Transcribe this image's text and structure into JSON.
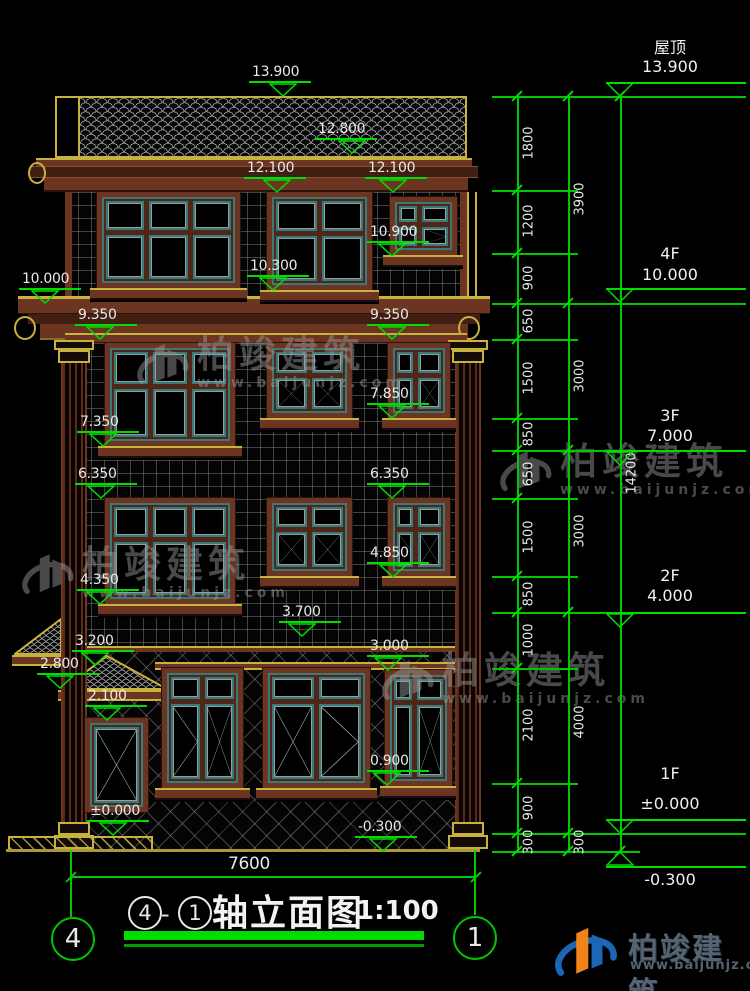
{
  "title": {
    "axis_from": "4",
    "dash": "-",
    "axis_to": "1",
    "name": "轴立面图",
    "scale": "1:100"
  },
  "axes": {
    "left": "4",
    "right": "1"
  },
  "dims": {
    "total_width": "7600",
    "ext_lines": [
      {
        "y": 96,
        "x1": 492,
        "x2": 746
      },
      {
        "y": 303,
        "x1": 492,
        "x2": 746
      },
      {
        "y": 450,
        "x1": 492,
        "x2": 746
      },
      {
        "y": 612,
        "x1": 492,
        "x2": 746
      },
      {
        "y": 833,
        "x1": 492,
        "x2": 746
      },
      {
        "y": 851,
        "x1": 492,
        "x2": 640
      },
      {
        "y": 190,
        "x1": 492,
        "x2": 578
      },
      {
        "y": 253,
        "x1": 492,
        "x2": 578
      },
      {
        "y": 339,
        "x1": 492,
        "x2": 578
      },
      {
        "y": 418,
        "x1": 492,
        "x2": 578
      },
      {
        "y": 498,
        "x1": 492,
        "x2": 578
      },
      {
        "y": 576,
        "x1": 492,
        "x2": 578
      },
      {
        "y": 668,
        "x1": 492,
        "x2": 578
      },
      {
        "y": 783,
        "x1": 492,
        "x2": 578
      }
    ],
    "chains": [
      {
        "x": 517,
        "y1": 96,
        "y2": 851,
        "ticks": [
          96,
          190,
          253,
          303,
          339,
          418,
          450,
          498,
          576,
          612,
          668,
          783,
          833,
          851
        ],
        "labels": [
          {
            "text": "1800",
            "y": 143
          },
          {
            "text": "1200",
            "y": 221
          },
          {
            "text": "900",
            "y": 278
          },
          {
            "text": "650",
            "y": 321
          },
          {
            "text": "1500",
            "y": 378
          },
          {
            "text": "850",
            "y": 434
          },
          {
            "text": "650",
            "y": 474
          },
          {
            "text": "1500",
            "y": 537
          },
          {
            "text": "850",
            "y": 594
          },
          {
            "text": "1000",
            "y": 640
          },
          {
            "text": "2100",
            "y": 725
          },
          {
            "text": "900",
            "y": 808
          },
          {
            "text": "300",
            "y": 842
          }
        ]
      },
      {
        "x": 568,
        "y1": 96,
        "y2": 851,
        "ticks": [
          96,
          303,
          450,
          612,
          833,
          851
        ],
        "labels": [
          {
            "text": "3900",
            "y": 199
          },
          {
            "text": "3000",
            "y": 376
          },
          {
            "text": "3000",
            "y": 531
          },
          {
            "text": "4000",
            "y": 722
          },
          {
            "text": "300",
            "y": 842
          }
        ]
      },
      {
        "x": 620,
        "y1": 96,
        "y2": 851,
        "ticks": [
          96,
          851
        ],
        "labels": [
          {
            "text": "14200",
            "y": 473
          }
        ]
      }
    ]
  },
  "floor_markers": [
    {
      "label": "屋顶",
      "value": "13.900",
      "line_y": 96,
      "bar_y": 82,
      "tri_y": 82,
      "label_y": 34,
      "value_y": 57,
      "flip": false
    },
    {
      "label": "4F",
      "value": "10.000",
      "line_y": 303,
      "bar_y": 288,
      "tri_y": 288,
      "label_y": 244,
      "value_y": 265,
      "flip": false
    },
    {
      "label": "3F",
      "value": "7.000",
      "line_y": 450,
      "bar_y": 450,
      "tri_y": 451,
      "label_y": 406,
      "value_y": 426,
      "flip": false
    },
    {
      "label": "2F",
      "value": "4.000",
      "line_y": 612,
      "bar_y": 612,
      "tri_y": 613,
      "label_y": 566,
      "value_y": 586,
      "flip": false
    },
    {
      "label": "1F",
      "value": "±0.000",
      "line_y": 833,
      "bar_y": 819,
      "tri_y": 819,
      "label_y": 764,
      "value_y": 794,
      "flip": false
    },
    {
      "label": "",
      "value": "-0.300",
      "line_y": 851,
      "bar_y": 866,
      "tri_y": 851,
      "label_y": 0,
      "value_y": 870,
      "flip": true
    }
  ],
  "elev_markers": [
    {
      "value": "13.900",
      "tx": 252,
      "tipx": 283,
      "tipy": 96
    },
    {
      "value": "12.800",
      "tx": 318,
      "tipx": 352,
      "tipy": 153
    },
    {
      "value": "12.100",
      "tx": 247,
      "tipx": 277,
      "tipy": 192
    },
    {
      "value": "12.100",
      "tx": 368,
      "tipx": 393,
      "tipy": 192
    },
    {
      "value": "10.900",
      "tx": 370,
      "tipx": 392,
      "tipy": 256
    },
    {
      "value": "10.300",
      "tx": 250,
      "tipx": 273,
      "tipy": 290
    },
    {
      "value": "10.000",
      "tx": 22,
      "tipx": 45,
      "tipy": 303
    },
    {
      "value": "9.350",
      "tx": 78,
      "tipx": 100,
      "tipy": 339
    },
    {
      "value": "9.350",
      "tx": 370,
      "tipx": 392,
      "tipy": 339
    },
    {
      "value": "7.850",
      "tx": 370,
      "tipx": 392,
      "tipy": 418
    },
    {
      "value": "7.350",
      "tx": 80,
      "tipx": 103,
      "tipy": 446
    },
    {
      "value": "6.350",
      "tx": 78,
      "tipx": 101,
      "tipy": 498
    },
    {
      "value": "6.350",
      "tx": 370,
      "tipx": 392,
      "tipy": 498
    },
    {
      "value": "4.850",
      "tx": 370,
      "tipx": 393,
      "tipy": 577
    },
    {
      "value": "4.350",
      "tx": 80,
      "tipx": 100,
      "tipy": 604
    },
    {
      "value": "3.700",
      "tx": 282,
      "tipx": 302,
      "tipy": 636
    },
    {
      "value": "3.200",
      "tx": 75,
      "tipx": 95,
      "tipy": 665
    },
    {
      "value": "3.000",
      "tx": 370,
      "tipx": 388,
      "tipy": 670
    },
    {
      "value": "2.800",
      "tx": 40,
      "tipx": 60,
      "tipy": 688
    },
    {
      "value": "2.100",
      "tx": 88,
      "tipx": 107,
      "tipy": 720
    },
    {
      "value": "0.900",
      "tx": 370,
      "tipx": 387,
      "tipy": 785
    },
    {
      "value": "±0.000",
      "tx": 90,
      "tipx": 113,
      "tipy": 835
    },
    {
      "value": "-0.300",
      "tx": 358,
      "tipx": 383,
      "tipy": 851
    }
  ],
  "building": {
    "windows": [
      {
        "id": "win-4f-left",
        "x": 97,
        "y": 192,
        "w": 143,
        "h": 96,
        "cols": [
          1,
          1,
          1
        ],
        "rows": [
          4,
          6
        ],
        "sym": null,
        "sill": {
          "x": 90,
          "y": 288,
          "w": 157
        }
      },
      {
        "id": "win-4f-center",
        "x": 267,
        "y": 192,
        "w": 105,
        "h": 98,
        "cols": [
          1,
          1
        ],
        "rows": [
          4,
          6
        ],
        "sym": null,
        "sill": {
          "x": 260,
          "y": 290,
          "w": 119
        }
      },
      {
        "id": "win-4f-right",
        "x": 390,
        "y": 197,
        "w": 67,
        "h": 58,
        "cols": [
          2,
          3
        ],
        "rows": [
          4,
          5
        ],
        "sym": [
          [
            null,
            null
          ],
          [
            null,
            "v"
          ]
        ],
        "sill": {
          "x": 383,
          "y": 255,
          "w": 80
        }
      },
      {
        "id": "win-3f-left",
        "x": 105,
        "y": 343,
        "w": 130,
        "h": 103,
        "cols": [
          1,
          1,
          1
        ],
        "rows": [
          4,
          6
        ],
        "sym": null,
        "sill": {
          "x": 98,
          "y": 446,
          "w": 144
        }
      },
      {
        "id": "win-3f-center",
        "x": 267,
        "y": 343,
        "w": 85,
        "h": 75,
        "cols": [
          1,
          1
        ],
        "rows": [
          4,
          6
        ],
        "sym": [
          [
            null,
            null
          ],
          [
            "x",
            "x"
          ]
        ],
        "sill": {
          "x": 260,
          "y": 418,
          "w": 99
        }
      },
      {
        "id": "win-3f-right",
        "x": 388,
        "y": 343,
        "w": 62,
        "h": 75,
        "cols": [
          2,
          3
        ],
        "rows": [
          4,
          6
        ],
        "sym": [
          [
            null,
            null
          ],
          [
            "v",
            "x"
          ]
        ],
        "sill": {
          "x": 382,
          "y": 418,
          "w": 74
        }
      },
      {
        "id": "win-2f-left",
        "x": 105,
        "y": 498,
        "w": 130,
        "h": 106,
        "cols": [
          1,
          1,
          1
        ],
        "rows": [
          4,
          7
        ],
        "sym": null,
        "sill": {
          "x": 98,
          "y": 604,
          "w": 144
        }
      },
      {
        "id": "win-2f-center",
        "x": 267,
        "y": 498,
        "w": 85,
        "h": 78,
        "cols": [
          1,
          1
        ],
        "rows": [
          4,
          7
        ],
        "sym": [
          [
            null,
            null
          ],
          [
            "x",
            "x"
          ]
        ],
        "sill": {
          "x": 260,
          "y": 576,
          "w": 99
        }
      },
      {
        "id": "win-2f-right",
        "x": 388,
        "y": 498,
        "w": 62,
        "h": 78,
        "cols": [
          2,
          3
        ],
        "rows": [
          4,
          7
        ],
        "sym": [
          [
            null,
            null
          ],
          [
            "v",
            "x"
          ]
        ],
        "sill": {
          "x": 382,
          "y": 576,
          "w": 74
        }
      },
      {
        "id": "win-1f-left",
        "x": 162,
        "y": 668,
        "w": 81,
        "h": 120,
        "cols": [
          1,
          1
        ],
        "rows": [
          2,
          7
        ],
        "sym": [
          [
            null,
            null
          ],
          [
            "v",
            "x"
          ]
        ],
        "sill": {
          "x": 155,
          "y": 788,
          "w": 95
        }
      },
      {
        "id": "win-1f-center",
        "x": 263,
        "y": 668,
        "w": 107,
        "h": 120,
        "cols": [
          1,
          1
        ],
        "rows": [
          2,
          7
        ],
        "sym": [
          [
            null,
            null
          ],
          [
            "x",
            "v"
          ]
        ],
        "sill": {
          "x": 256,
          "y": 788,
          "w": 121
        }
      },
      {
        "id": "win-1f-right",
        "x": 385,
        "y": 670,
        "w": 67,
        "h": 116,
        "cols": [
          2,
          3
        ],
        "rows": [
          2,
          7
        ],
        "sym": [
          [
            null,
            null
          ],
          [
            null,
            "x"
          ]
        ],
        "sill": {
          "x": 380,
          "y": 786,
          "w": 76
        }
      },
      {
        "id": "entry-door",
        "x": 85,
        "y": 718,
        "w": 63,
        "h": 94,
        "cols": [
          1
        ],
        "rows": [
          1
        ],
        "sym": [
          [
            "x"
          ]
        ],
        "sill": null
      }
    ]
  },
  "watermark": {
    "icon": "building-logo-icon",
    "name": "柏竣建筑",
    "url": "www.baijunjz.com",
    "color": "#9a9a9a",
    "positions": [
      {
        "x": 133,
        "y": 336
      },
      {
        "x": 496,
        "y": 443
      },
      {
        "x": 18,
        "y": 546
      },
      {
        "x": 378,
        "y": 652
      }
    ]
  },
  "footer_logo": {
    "icon": "building-logo-icon",
    "name": "柏竣建筑",
    "url": "www.baijunjz.com",
    "text_color": "#566373",
    "colors": {
      "swoosh": "#1b66b5",
      "tower_left": "#f08418",
      "tower_right": "#1b66b5"
    }
  }
}
